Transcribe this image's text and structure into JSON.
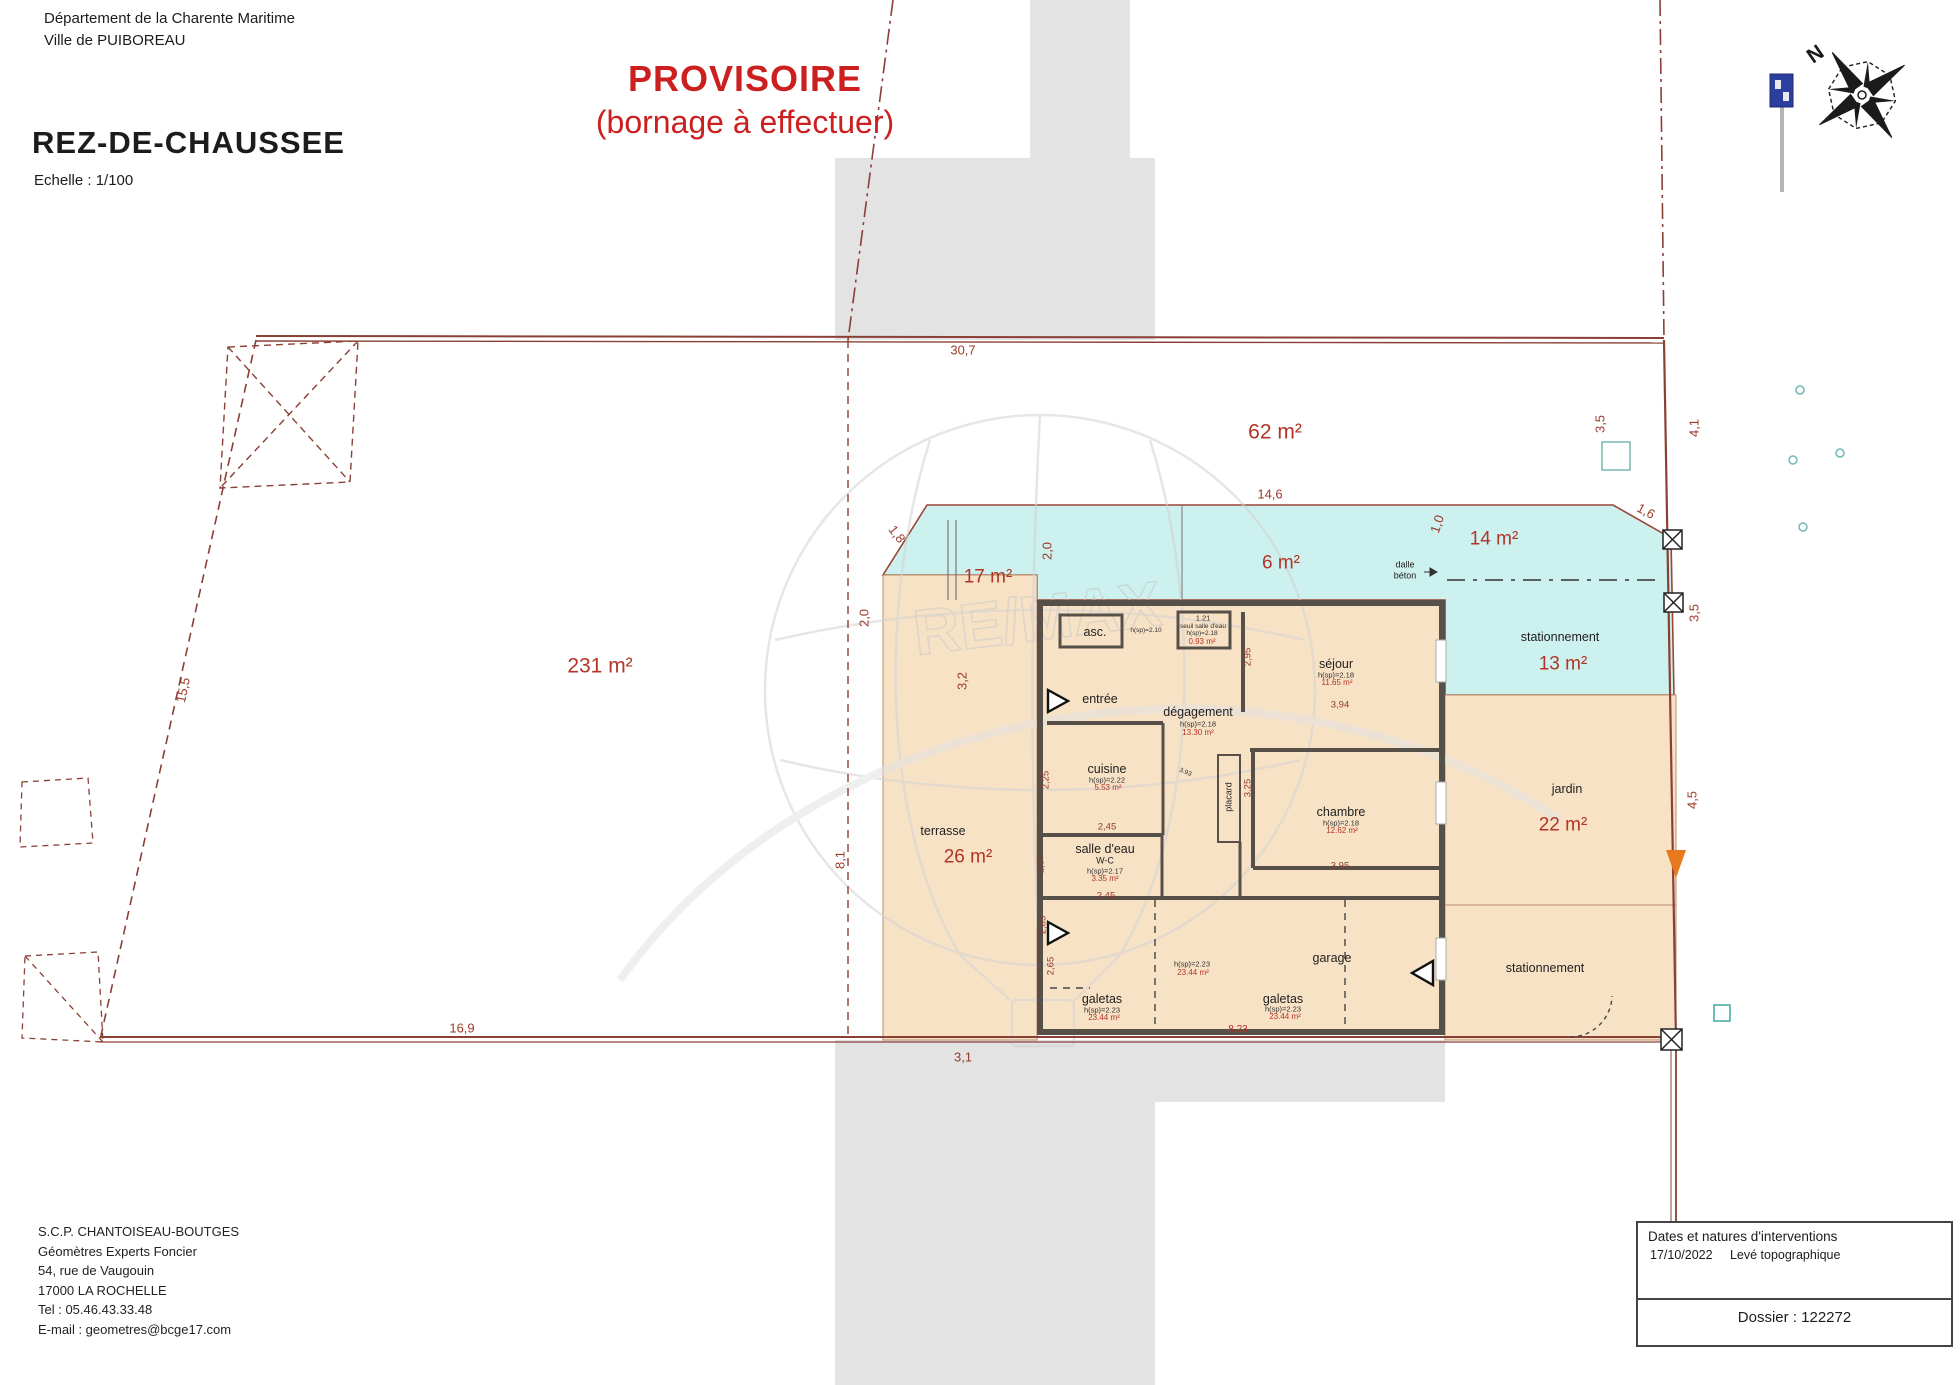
{
  "header": {
    "line1": "Département de la Charente Maritime",
    "line2": "Ville de PUIBOREAU",
    "plan_title": "REZ-DE-CHAUSSEE",
    "scale": "Echelle : 1/100",
    "provisional_line1": "PROVISOIRE",
    "provisional_line2": "(bornage à effectuer)"
  },
  "surveyor": {
    "name": "S.C.P. CHANTOISEAU-BOUTGES",
    "role": "Géomètres Experts Foncier",
    "address": "54, rue de Vaugouin",
    "city": "17000 LA ROCHELLE",
    "tel": "Tel : 05.46.43.33.48",
    "email": "E-mail : geometres@bcge17.com"
  },
  "title_block": {
    "title": "Dates et natures d'interventions",
    "date": "17/10/2022",
    "nature": "Levé topographique",
    "dossier": "Dossier : 122272"
  },
  "compass": {
    "north_letter": "N"
  },
  "watermark": {
    "text": "RE/MAX"
  },
  "colors": {
    "boundary": "#8a4034",
    "dimension_text": "#9c3a2b",
    "area_text": "#b23426",
    "cyan_zone": "#cdf1ee",
    "beige_zone": "#f8e2c6",
    "gray_zone": "#e3e3e3",
    "provisional_red": "#cc1f1f",
    "orange_marker": "#e8791e",
    "sign_blue": "#2b3f9e"
  },
  "zones": [
    {
      "name": "parcelle-ouest",
      "area": "231 m²"
    },
    {
      "name": "parcelle-nord",
      "area": "62 m²"
    },
    {
      "name": "cour-17",
      "area": "17 m²"
    },
    {
      "name": "cour-6",
      "area": "6 m²"
    },
    {
      "name": "cour-14",
      "area": "14 m²"
    },
    {
      "name": "stationnement-nord",
      "area": "13 m²"
    },
    {
      "name": "terrasse",
      "area": "26 m²"
    },
    {
      "name": "jardin",
      "area": "22 m²"
    },
    {
      "name": "stationnement-sud",
      "area": ""
    }
  ],
  "rooms": [
    {
      "name": "asc.",
      "height": "h(sp)=2.10",
      "area": ""
    },
    {
      "name": "seuil salle d'eau",
      "dim": "1.21",
      "height": "h(sp)=2.18",
      "area": "0.93 m²"
    },
    {
      "name": "entrée",
      "height": "",
      "area": ""
    },
    {
      "name": "dégagement",
      "height": "h(sp)=2.18",
      "area": "13.30 m²"
    },
    {
      "name": "séjour",
      "height": "h(sp)=2.18",
      "area": "11.65 m²"
    },
    {
      "name": "cuisine",
      "height": "h(sp)=2.22",
      "area": "5.53 m²"
    },
    {
      "name": "placard",
      "height": "",
      "area": ""
    },
    {
      "name": "chambre",
      "height": "h(sp)=2.18",
      "area": "12.62 m²"
    },
    {
      "name": "salle d'eau W-C",
      "height": "h(sp)=2.17",
      "area": "3.35 m²"
    },
    {
      "name": "galetas",
      "height": "h(sp)=2.23",
      "area": "23.44 m²"
    },
    {
      "name": "galetas",
      "height": "h(sp)=2.23",
      "area": "23.44 m²"
    },
    {
      "name": "garage",
      "height": "h(sp)=2.23",
      "area": "23.44 m²"
    },
    {
      "name": "dalle béton",
      "height": "",
      "area": ""
    }
  ],
  "labels": [
    {
      "t": "30,7",
      "x": 963,
      "y": 350,
      "rot": 0,
      "cls": "dim"
    },
    {
      "t": "62 m²",
      "x": 1275,
      "y": 432,
      "rot": 0,
      "cls": "areaL"
    },
    {
      "t": "231 m²",
      "x": 600,
      "y": 666,
      "rot": 0,
      "cls": "areaL"
    },
    {
      "t": "3,5",
      "x": 1600,
      "y": 424,
      "rot": -90,
      "cls": "dim"
    },
    {
      "t": "4,1",
      "x": 1694,
      "y": 428,
      "rot": -90,
      "cls": "dim"
    },
    {
      "t": "14,6",
      "x": 1270,
      "y": 494,
      "rot": 0,
      "cls": "dim"
    },
    {
      "t": "1,6",
      "x": 1646,
      "y": 511,
      "rot": 28,
      "cls": "dim"
    },
    {
      "t": "1,0",
      "x": 1437,
      "y": 524,
      "rot": -72,
      "cls": "dim"
    },
    {
      "t": "17 m²",
      "x": 988,
      "y": 577,
      "rot": 0,
      "cls": "area"
    },
    {
      "t": "6 m²",
      "x": 1281,
      "y": 563,
      "rot": 0,
      "cls": "area"
    },
    {
      "t": "14 m²",
      "x": 1494,
      "y": 539,
      "rot": 0,
      "cls": "area"
    },
    {
      "t": "2,0",
      "x": 1047,
      "y": 551,
      "rot": -90,
      "cls": "dim"
    },
    {
      "t": "1,8",
      "x": 897,
      "y": 534,
      "rot": 52,
      "cls": "dim"
    },
    {
      "t": "dalle",
      "x": 1405,
      "y": 565,
      "rot": 0,
      "cls": "roomsm"
    },
    {
      "t": "béton",
      "x": 1405,
      "y": 576,
      "rot": 0,
      "cls": "roomsm"
    },
    {
      "t": "3,5",
      "x": 1694,
      "y": 613,
      "rot": -90,
      "cls": "dim"
    },
    {
      "t": "stationnement",
      "x": 1560,
      "y": 637,
      "rot": 0,
      "cls": "room"
    },
    {
      "t": "13 m²",
      "x": 1563,
      "y": 664,
      "rot": 0,
      "cls": "area"
    },
    {
      "t": "jardin",
      "x": 1567,
      "y": 789,
      "rot": 0,
      "cls": "room"
    },
    {
      "t": "22 m²",
      "x": 1563,
      "y": 825,
      "rot": 0,
      "cls": "area"
    },
    {
      "t": "4,5",
      "x": 1692,
      "y": 800,
      "rot": -90,
      "cls": "dim"
    },
    {
      "t": "stationnement",
      "x": 1545,
      "y": 968,
      "rot": 0,
      "cls": "room"
    },
    {
      "t": "terrasse",
      "x": 943,
      "y": 831,
      "rot": 0,
      "cls": "room"
    },
    {
      "t": "26 m²",
      "x": 968,
      "y": 857,
      "rot": 0,
      "cls": "area"
    },
    {
      "t": "3,2",
      "x": 962,
      "y": 681,
      "rot": -90,
      "cls": "dim"
    },
    {
      "t": "2,0",
      "x": 864,
      "y": 618,
      "rot": -90,
      "cls": "dim"
    },
    {
      "t": "8,1",
      "x": 840,
      "y": 860,
      "rot": -90,
      "cls": "dim"
    },
    {
      "t": "15,5",
      "x": 183,
      "y": 690,
      "rot": -78,
      "cls": "dim"
    },
    {
      "t": "16,9",
      "x": 462,
      "y": 1028,
      "rot": 0,
      "cls": "dim"
    },
    {
      "t": "3,1",
      "x": 963,
      "y": 1057,
      "rot": 0,
      "cls": "dim"
    },
    {
      "t": "8,23",
      "x": 1238,
      "y": 1030,
      "rot": 0,
      "cls": "dimred"
    },
    {
      "t": "2,65",
      "x": 1051,
      "y": 966,
      "rot": -90,
      "cls": "dimsm"
    },
    {
      "t": "asc.",
      "x": 1095,
      "y": 632,
      "rot": 0,
      "cls": "room"
    },
    {
      "t": "h(sp)=2.10",
      "x": 1146,
      "y": 631,
      "rot": 0,
      "cls": "tiny2"
    },
    {
      "t": "1.21",
      "x": 1203,
      "y": 618,
      "rot": 0,
      "cls": "tiny"
    },
    {
      "t": "seuil salle d'eau",
      "x": 1203,
      "y": 627,
      "rot": 0,
      "cls": "tiny2"
    },
    {
      "t": "h(sp)=2.18",
      "x": 1202,
      "y": 634,
      "rot": 0,
      "cls": "tiny2"
    },
    {
      "t": "0.93 m²",
      "x": 1202,
      "y": 642,
      "rot": 0,
      "cls": "tinyred"
    },
    {
      "t": "entrée",
      "x": 1100,
      "y": 699,
      "rot": 0,
      "cls": "room"
    },
    {
      "t": "dégagement",
      "x": 1198,
      "y": 712,
      "rot": 0,
      "cls": "room"
    },
    {
      "t": "h(sp)=2.18",
      "x": 1198,
      "y": 724,
      "rot": 0,
      "cls": "tiny"
    },
    {
      "t": "13.30 m²",
      "x": 1198,
      "y": 733,
      "rot": 0,
      "cls": "tinyred"
    },
    {
      "t": "séjour",
      "x": 1336,
      "y": 664,
      "rot": 0,
      "cls": "room"
    },
    {
      "t": "h(sp)=2.18",
      "x": 1336,
      "y": 675,
      "rot": 0,
      "cls": "tiny"
    },
    {
      "t": "11.65 m²",
      "x": 1337,
      "y": 683,
      "rot": 0,
      "cls": "tinyred"
    },
    {
      "t": "cuisine",
      "x": 1107,
      "y": 769,
      "rot": 0,
      "cls": "room"
    },
    {
      "t": "h(sp)=2.22",
      "x": 1107,
      "y": 780,
      "rot": 0,
      "cls": "tiny"
    },
    {
      "t": "5.53 m²",
      "x": 1108,
      "y": 788,
      "rot": 0,
      "cls": "tinyred"
    },
    {
      "t": "placard",
      "x": 1229,
      "y": 797,
      "rot": -90,
      "cls": "roomsm"
    },
    {
      "t": "3.93",
      "x": 1185,
      "y": 773,
      "rot": 22,
      "cls": "tiny2"
    },
    {
      "t": "chambre",
      "x": 1341,
      "y": 812,
      "rot": 0,
      "cls": "room"
    },
    {
      "t": "h(sp)=2.18",
      "x": 1341,
      "y": 823,
      "rot": 0,
      "cls": "tiny"
    },
    {
      "t": "12.62 m²",
      "x": 1342,
      "y": 831,
      "rot": 0,
      "cls": "tinyred"
    },
    {
      "t": "2,45",
      "x": 1107,
      "y": 827,
      "rot": 0,
      "cls": "dimsm"
    },
    {
      "t": "salle d'eau",
      "x": 1105,
      "y": 849,
      "rot": 0,
      "cls": "room"
    },
    {
      "t": "W-C",
      "x": 1105,
      "y": 861,
      "rot": 0,
      "cls": "roomsm"
    },
    {
      "t": "h(sp)=2.17",
      "x": 1105,
      "y": 871,
      "rot": 0,
      "cls": "tiny"
    },
    {
      "t": "3.35 m²",
      "x": 1105,
      "y": 879,
      "rot": 0,
      "cls": "tinyred"
    },
    {
      "t": "2,45",
      "x": 1106,
      "y": 896,
      "rot": 0,
      "cls": "dimsm"
    },
    {
      "t": "1,37",
      "x": 1041,
      "y": 864,
      "rot": -90,
      "cls": "dimsm"
    },
    {
      "t": "2,25",
      "x": 1046,
      "y": 780,
      "rot": -90,
      "cls": "dimsm"
    },
    {
      "t": "2,95",
      "x": 1248,
      "y": 657,
      "rot": -90,
      "cls": "dimsm"
    },
    {
      "t": "3,25",
      "x": 1248,
      "y": 788,
      "rot": -90,
      "cls": "dimsm"
    },
    {
      "t": "3,94",
      "x": 1340,
      "y": 705,
      "rot": 0,
      "cls": "dimsm"
    },
    {
      "t": "3,95",
      "x": 1340,
      "y": 866,
      "rot": 0,
      "cls": "dimsm"
    },
    {
      "t": "2,85",
      "x": 1043,
      "y": 925,
      "rot": -90,
      "cls": "dimsm"
    },
    {
      "t": "galetas",
      "x": 1102,
      "y": 999,
      "rot": 0,
      "cls": "room"
    },
    {
      "t": "h(sp)=2.23",
      "x": 1102,
      "y": 1010,
      "rot": 0,
      "cls": "tiny"
    },
    {
      "t": "23.44 m²",
      "x": 1104,
      "y": 1018,
      "rot": 0,
      "cls": "tinyred"
    },
    {
      "t": "h(sp)=2.23",
      "x": 1192,
      "y": 964,
      "rot": 0,
      "cls": "tiny"
    },
    {
      "t": "23.44 m²",
      "x": 1193,
      "y": 973,
      "rot": 0,
      "cls": "tinyred"
    },
    {
      "t": "galetas",
      "x": 1283,
      "y": 999,
      "rot": 0,
      "cls": "room"
    },
    {
      "t": "h(sp)=2.23",
      "x": 1283,
      "y": 1009,
      "rot": 0,
      "cls": "tiny"
    },
    {
      "t": "23.44 m²",
      "x": 1285,
      "y": 1017,
      "rot": 0,
      "cls": "tinyred"
    },
    {
      "t": "garage",
      "x": 1332,
      "y": 958,
      "rot": 0,
      "cls": "room"
    }
  ]
}
